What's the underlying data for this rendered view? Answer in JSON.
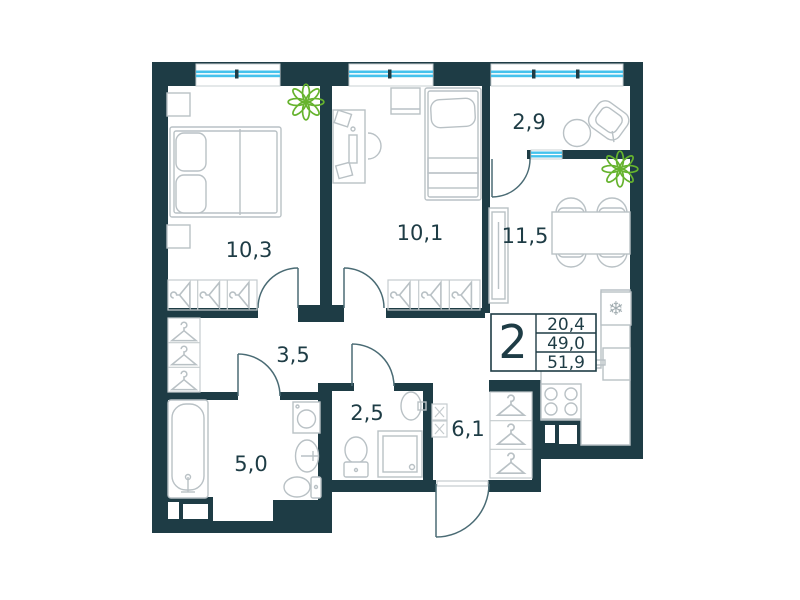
{
  "plan_type": "apartment-floor-plan",
  "colors": {
    "wall": "#1e3c45",
    "window_glass": "#45c2ec",
    "furniture_line": "#b9c1c5",
    "plant_green": "#66b32e",
    "label_text": "#1e3c45"
  },
  "rooms": {
    "bedroom_left": {
      "area": "10,3"
    },
    "bedroom_mid": {
      "area": "10,1"
    },
    "balcony": {
      "area": "2,9"
    },
    "kitchen_living": {
      "area": "11,5"
    },
    "corridor": {
      "area": "3,5"
    },
    "bathroom": {
      "area": "5,0"
    },
    "wc": {
      "area": "2,5"
    },
    "hallway": {
      "area": "6,1"
    }
  },
  "spec_table": {
    "rooms_count": "2",
    "living_area": "20,4",
    "apartment_area": "49,0",
    "total_area": "51,9"
  },
  "icons": {
    "fridge_snowflake": "❄"
  }
}
